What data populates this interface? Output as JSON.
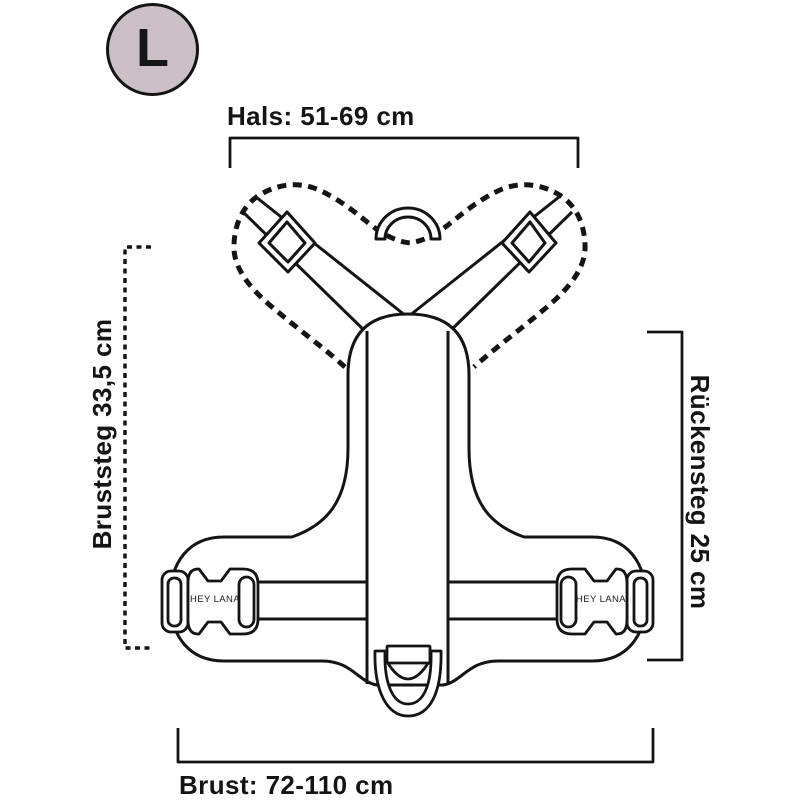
{
  "diagram": {
    "type": "dog-harness size diagram",
    "size_badge": {
      "label": "L",
      "fill": "#cbc0c8"
    },
    "measurements": {
      "neck": {
        "label": "Hals: 51-69 cm"
      },
      "chest_girth": {
        "label": "Brust: 72-110 cm"
      },
      "chest_strap": {
        "label": "Bruststeg 33,5 cm"
      },
      "back_strap": {
        "label": "Rückensteg 25 cm"
      }
    },
    "brand": {
      "name": "HEY LANA"
    },
    "colors": {
      "line": "#141414",
      "badge_fill": "#cbc0c8",
      "background": "#ffffff"
    }
  }
}
